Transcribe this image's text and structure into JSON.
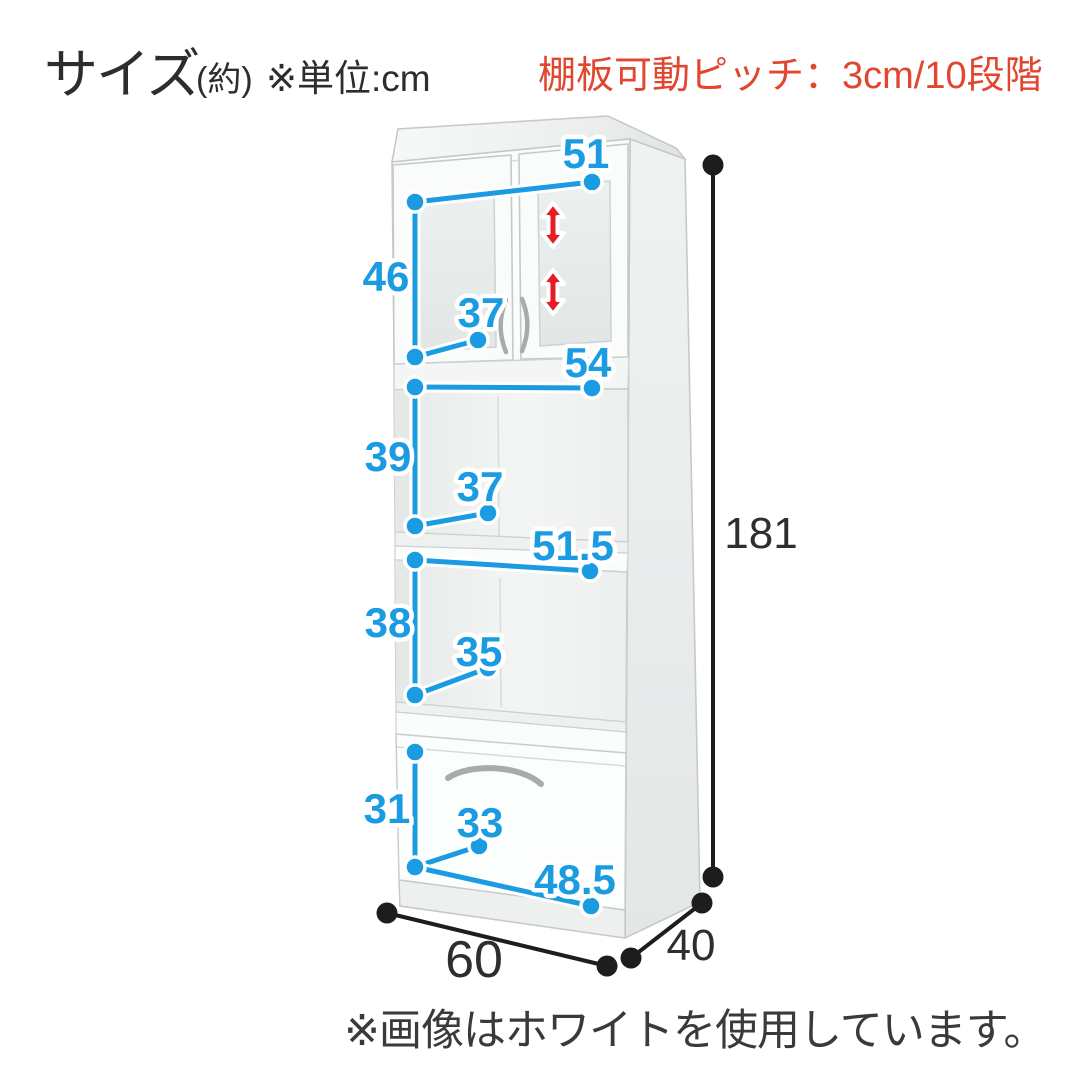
{
  "header": {
    "title": "サイズ",
    "title_suffix": "(約)",
    "unit_note": "※単位:cm",
    "shelf_pitch_note": "棚板可動ピッチ：3cm/10段階"
  },
  "footer": {
    "color_note": "※画像はホワイトを使用しています。"
  },
  "colors": {
    "dimension_blue": "#1b9ce2",
    "note_red": "#e2462e",
    "arrow_red": "#e51d25",
    "outline_black": "#1d1d1d"
  },
  "diagram": {
    "unit": "cm",
    "overall": {
      "height": "181",
      "width": "60",
      "depth": "40"
    },
    "sections": {
      "upper_cabinet": {
        "width": "51",
        "height": "46",
        "depth": "37"
      },
      "open_shelf_upper": {
        "width": "54",
        "height": "39",
        "depth": "37"
      },
      "open_shelf_lower": {
        "width": "51.5",
        "height": "38",
        "depth": "35"
      },
      "drawer": {
        "width": "48.5",
        "height": "31",
        "depth": "33"
      }
    }
  }
}
